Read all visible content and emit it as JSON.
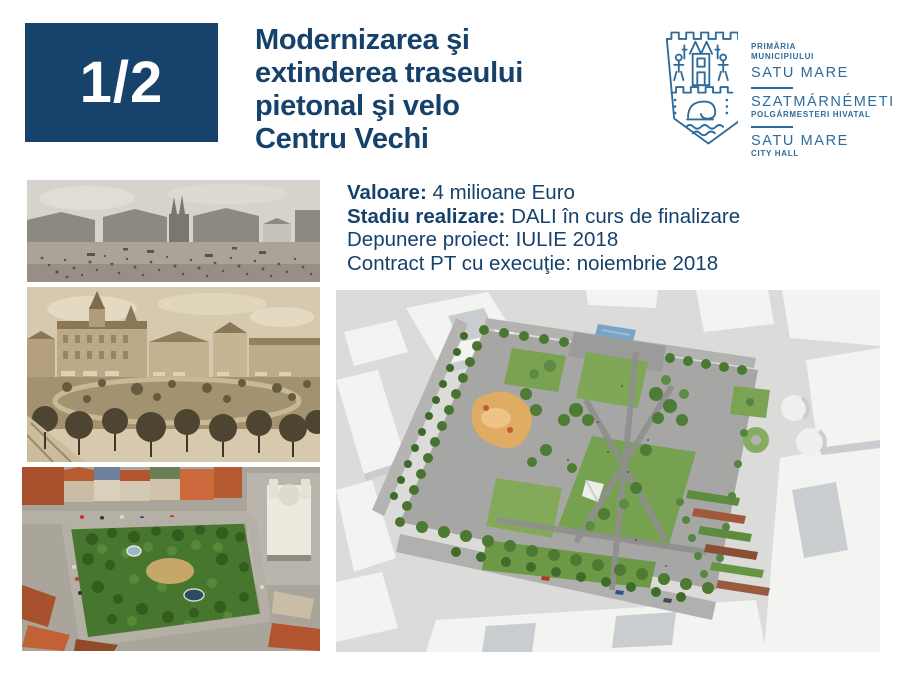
{
  "slide": {
    "page_badge": "1/2",
    "title_lines": [
      "Modernizarea şi",
      "extinderea traseului",
      "pietonal şi velo",
      "Centru Vechi"
    ]
  },
  "logo": {
    "line1": "PRIMĂRIA",
    "line2": "MUNICIPIULUI",
    "line3": "SATU MARE",
    "line4": "SZATMÁRNÉMETI",
    "line5": "POLGÁRMESTERI HIVATAL",
    "line6": "SATU MARE",
    "line7": "CITY HALL",
    "crest_icon": "satu-mare-city-crest"
  },
  "project_details": {
    "valoare_label": "Valoare:",
    "valoare_value": "4 milioane Euro",
    "stadiu_label": "Stadiu realizare:",
    "stadiu_value": "DALI în curs de finalizare",
    "line3": "Depunere proiect: IULIE 2018",
    "line4": "Contract PT cu execuţie: noiembrie 2018"
  },
  "images": {
    "photo_top": "historic-market-square-photo",
    "photo_middle": "vintage-city-square-postcard",
    "photo_bottom": "aerial-park-photo",
    "main_render": "park-redesign-3d-render"
  },
  "colors": {
    "navy": "#17426C",
    "logo_blue": "#2E6B9B"
  }
}
